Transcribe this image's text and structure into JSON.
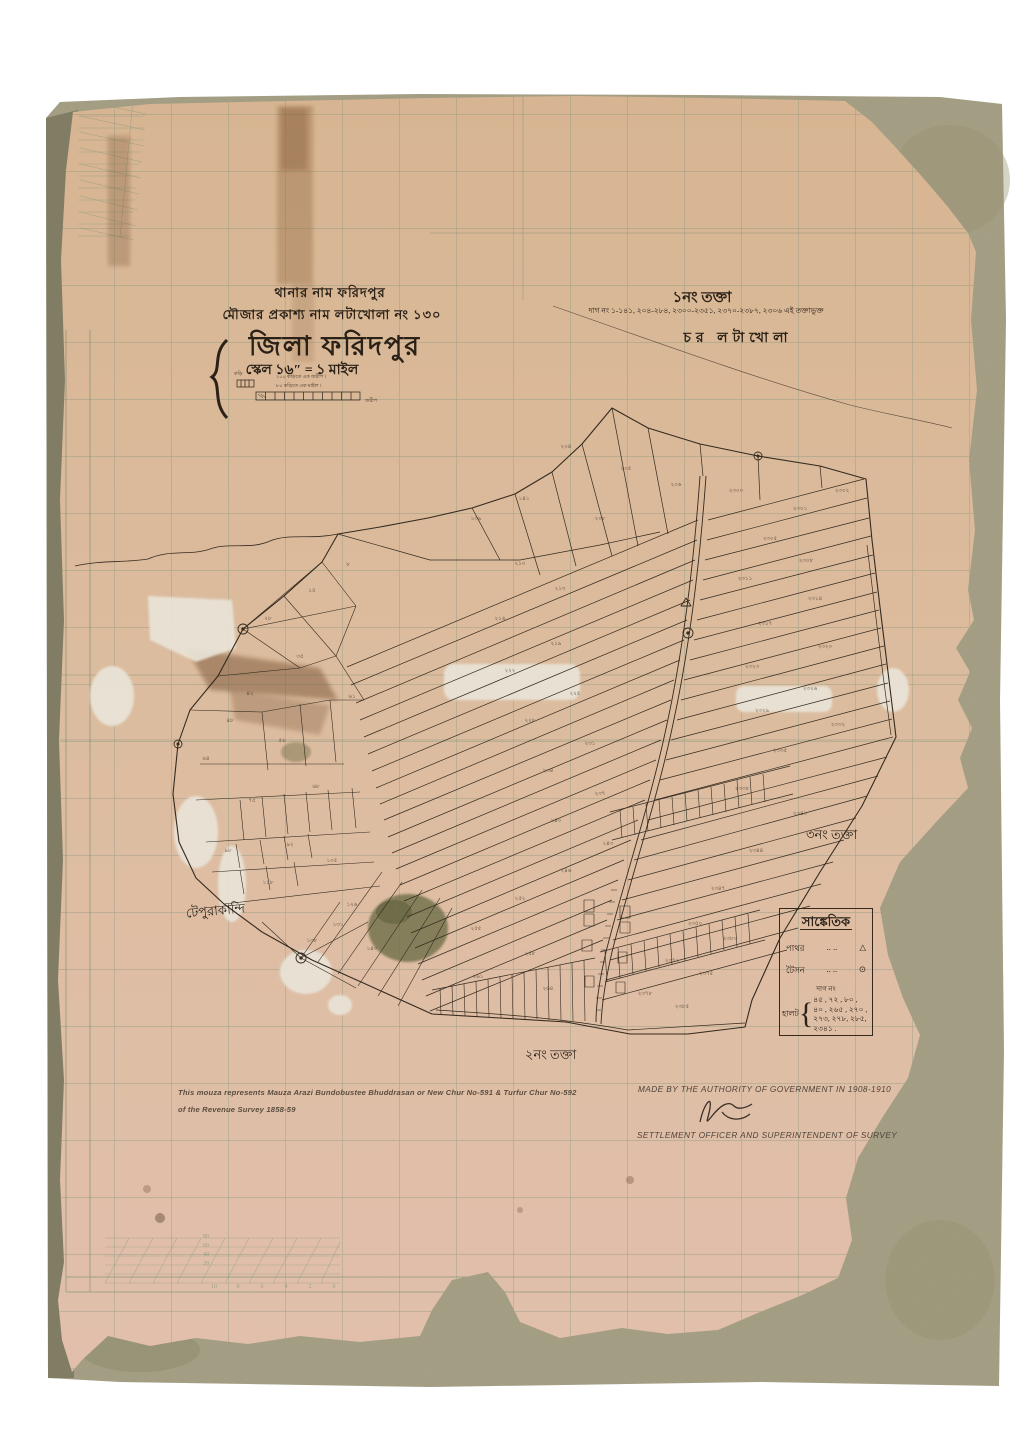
{
  "header": {
    "thana_line": "থানার নাম ফরিদপুর",
    "mouza_line": "মৌজার প্রকাশ্য নাম লটাখোলা নং ১৩০",
    "district_title": "জিলা ফরিদপুর",
    "scale_line": "স্কেল ১৬″ = ১ মাইল",
    "scale_note_top": "১০০ কড়িতে এক জরীপ ।",
    "scale_note_bottom": "৮০ কড়িতে এক মাইল ।",
    "scale_unit_small": "কড়ি",
    "scale_bar_end_label": "জরীপ"
  },
  "sheet_info": {
    "sheet_no": "১নং তক্তা",
    "dag_range_line": "দাগ নং ১-১৪১, ২০৪-২৮৪, ২৩০০-২৩৫১, ২৩৭০-২৩৮৭, ২৩০৬ এই তক্তাভুক্ত",
    "char_name": "চর লটাখোলা"
  },
  "map_labels": {
    "sheet2": "২নং তক্তা",
    "sheet3": "৩নং তক্তা",
    "village_west": "টেপুরাকান্দি"
  },
  "legend": {
    "title": "সাঙ্কেতিক",
    "rows": [
      {
        "label": "পাথর",
        "dots": "..    ..",
        "symbol": "△"
      },
      {
        "label": "টৈসন",
        "dots": "..    ..",
        "symbol": "⊙"
      }
    ],
    "dag_heading": "দাগ নং",
    "group_label": "হালট",
    "brace": "{",
    "halot_lines": [
      "৪৫ , ৭২ , ৮০ ,",
      "৪০ , ২৬৫ , ২৭০ ,",
      "২৭৩, ২৭৮, ২৮৫,",
      "২৩৪১ ."
    ]
  },
  "footer": {
    "note_line1": "This mouza represents Mauza Arazi Bundobustee Bhuddrasan or New Chur No-591 & Turfur Chur No-592",
    "note_line2": "of the Revenue Survey 1858-59",
    "authority_line": "MADE BY THE AUTHORITY OF GOVERNMENT IN 1908-1910",
    "officer_line": "SETTLEMENT OFFICER AND SUPERINTENDENT OF SURVEY"
  },
  "margin_numbers": [
    {
      "x": 206,
      "y": 1237,
      "t": "80"
    },
    {
      "x": 206,
      "y": 1246,
      "t": "60"
    },
    {
      "x": 206,
      "y": 1255,
      "t": "40"
    },
    {
      "x": 206,
      "y": 1264,
      "t": "20"
    },
    {
      "x": 214,
      "y": 1287,
      "t": "10"
    },
    {
      "x": 238,
      "y": 1287,
      "t": "8"
    },
    {
      "x": 262,
      "y": 1287,
      "t": "6"
    },
    {
      "x": 286,
      "y": 1287,
      "t": "4"
    },
    {
      "x": 310,
      "y": 1287,
      "t": "2"
    },
    {
      "x": 334,
      "y": 1287,
      "t": "0"
    }
  ],
  "plot_numbers": [
    {
      "x": 250,
      "y": 695,
      "t": "৪২"
    },
    {
      "x": 282,
      "y": 742,
      "t": "৫৬"
    },
    {
      "x": 316,
      "y": 788,
      "t": "৬৮"
    },
    {
      "x": 252,
      "y": 802,
      "t": "৭৫"
    },
    {
      "x": 290,
      "y": 846,
      "t": "৯২"
    },
    {
      "x": 332,
      "y": 862,
      "t": "১০৫"
    },
    {
      "x": 268,
      "y": 884,
      "t": "১১৮"
    },
    {
      "x": 352,
      "y": 906,
      "t": "১২৬"
    },
    {
      "x": 312,
      "y": 942,
      "t": "১৩৮"
    },
    {
      "x": 228,
      "y": 852,
      "t": "৯৮"
    },
    {
      "x": 352,
      "y": 698,
      "t": "৬১"
    },
    {
      "x": 300,
      "y": 658,
      "t": "৩৫"
    },
    {
      "x": 268,
      "y": 620,
      "t": "২৮"
    },
    {
      "x": 312,
      "y": 592,
      "t": "১৫"
    },
    {
      "x": 348,
      "y": 566,
      "t": "৮"
    },
    {
      "x": 230,
      "y": 722,
      "t": "৪৮"
    },
    {
      "x": 206,
      "y": 760,
      "t": "৬৪"
    },
    {
      "x": 338,
      "y": 926,
      "t": "১৩১"
    },
    {
      "x": 372,
      "y": 950,
      "t": "১৪০"
    },
    {
      "x": 566,
      "y": 448,
      "t": "২০৪"
    },
    {
      "x": 626,
      "y": 470,
      "t": "২০৫"
    },
    {
      "x": 676,
      "y": 486,
      "t": "২০৬"
    },
    {
      "x": 524,
      "y": 500,
      "t": "১৪১"
    },
    {
      "x": 476,
      "y": 520,
      "t": "১৩৯"
    },
    {
      "x": 600,
      "y": 520,
      "t": "২০৮"
    },
    {
      "x": 736,
      "y": 492,
      "t": "২৩০০"
    },
    {
      "x": 800,
      "y": 510,
      "t": "২৩০১"
    },
    {
      "x": 842,
      "y": 492,
      "t": "২৩০২"
    },
    {
      "x": 520,
      "y": 565,
      "t": "২১০"
    },
    {
      "x": 560,
      "y": 590,
      "t": "২১৩"
    },
    {
      "x": 500,
      "y": 620,
      "t": "২১৬"
    },
    {
      "x": 556,
      "y": 645,
      "t": "২১৯"
    },
    {
      "x": 510,
      "y": 672,
      "t": "২২২"
    },
    {
      "x": 575,
      "y": 695,
      "t": "২২৫"
    },
    {
      "x": 530,
      "y": 722,
      "t": "২২৮"
    },
    {
      "x": 590,
      "y": 745,
      "t": "২৩১"
    },
    {
      "x": 548,
      "y": 772,
      "t": "২৩৪"
    },
    {
      "x": 600,
      "y": 795,
      "t": "২৩৭"
    },
    {
      "x": 556,
      "y": 822,
      "t": "২৪০"
    },
    {
      "x": 608,
      "y": 845,
      "t": "২৪৩"
    },
    {
      "x": 566,
      "y": 872,
      "t": "২৪৬"
    },
    {
      "x": 520,
      "y": 900,
      "t": "২৫২"
    },
    {
      "x": 476,
      "y": 930,
      "t": "২৫৫"
    },
    {
      "x": 530,
      "y": 955,
      "t": "২৫৮"
    },
    {
      "x": 478,
      "y": 978,
      "t": "২৬১"
    },
    {
      "x": 548,
      "y": 990,
      "t": "২৬৪"
    },
    {
      "x": 770,
      "y": 540,
      "t": "২৩০৫"
    },
    {
      "x": 806,
      "y": 562,
      "t": "২৩০৮"
    },
    {
      "x": 745,
      "y": 580,
      "t": "২৩১১"
    },
    {
      "x": 815,
      "y": 600,
      "t": "২৩১৪"
    },
    {
      "x": 765,
      "y": 625,
      "t": "২৩১৭"
    },
    {
      "x": 825,
      "y": 648,
      "t": "২৩২০"
    },
    {
      "x": 752,
      "y": 668,
      "t": "২৩২৩"
    },
    {
      "x": 810,
      "y": 690,
      "t": "২৩২৬"
    },
    {
      "x": 762,
      "y": 712,
      "t": "২৩২৯"
    },
    {
      "x": 838,
      "y": 726,
      "t": "২৩৩২"
    },
    {
      "x": 780,
      "y": 752,
      "t": "২৩৩৫"
    },
    {
      "x": 742,
      "y": 790,
      "t": "২৩৩৮"
    },
    {
      "x": 800,
      "y": 815,
      "t": "২৩৪১"
    },
    {
      "x": 756,
      "y": 852,
      "t": "২৩৪৪"
    },
    {
      "x": 718,
      "y": 890,
      "t": "২৩৪৭"
    },
    {
      "x": 695,
      "y": 925,
      "t": "২৩৫০"
    },
    {
      "x": 672,
      "y": 962,
      "t": "২৩৭২"
    },
    {
      "x": 706,
      "y": 975,
      "t": "২৩৭৫"
    },
    {
      "x": 645,
      "y": 995,
      "t": "২৩৭৮"
    },
    {
      "x": 730,
      "y": 940,
      "t": "২৩৮০"
    },
    {
      "x": 682,
      "y": 1008,
      "t": "২৩৮৫"
    }
  ],
  "colors": {
    "backing_board": "#a49e83",
    "paper": "#dcbc9e",
    "grid_green": "#6f8f74",
    "ink": "#342a1f"
  }
}
